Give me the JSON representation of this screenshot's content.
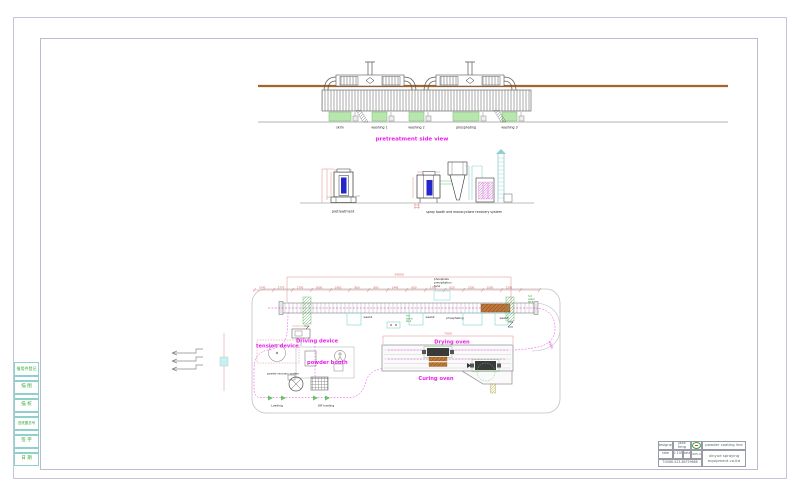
{
  "frame": {
    "strip_cells": [
      "借用件登记",
      "描 图",
      "描 校",
      "旧底图总号",
      "签 字",
      "日 期"
    ]
  },
  "side_view": {
    "title": "pretreatment side view",
    "tank_labels": [
      "skim",
      "washing 1",
      "washing 2",
      "phosphating",
      "washing 3"
    ]
  },
  "elevations": {
    "left_label": "pretreatment",
    "right_label": "spray booth and monocyclone recovery system"
  },
  "plan": {
    "total_dim": "24050",
    "oven_dim": "7500",
    "radius_dim": "R900",
    "dims": [
      "1500",
      "2770",
      "1700",
      "3000",
      "1950",
      "860",
      "895",
      "1445",
      "600",
      "1700",
      "620",
      "1500",
      "2500",
      "2200"
    ],
    "phosphate_lines": [
      "phosphate",
      "precipitation",
      "tank"
    ],
    "hot_water_lines": [
      "hot",
      "water",
      "tank"
    ],
    "tank_labels": {
      "wash1": "wash1",
      "wash2": "wash2",
      "phosphating": "phosphating",
      "wash3": "wash3"
    },
    "labels": {
      "tension": "tension device",
      "driving": "Driving device",
      "powder_booth": "powder booth",
      "recovery": "powder recovery system",
      "drying": "Drying oven",
      "curing": "Curing oven",
      "loading": "Loading",
      "offloading": "Off loading"
    }
  },
  "title_block": {
    "designer_label": "designer",
    "designer": "jake feng",
    "scale_label": "rate",
    "scale": "1:100",
    "date_label": "date",
    "date": "2005.07",
    "phone": "T:0086-523-86759666",
    "project": "powder coating line",
    "company_line1": "xinyue spraying",
    "company_line2": "equipment co.ltd"
  },
  "colors": {
    "magenta": "#ea1eea",
    "dim_red": "#dd7a7a",
    "rail_brown": "#a2652c",
    "tank_green": "#b9e6ae",
    "cyan": "#7fd4d4",
    "core_blue": "#2525cc",
    "strip_green": "#2fa82f"
  }
}
